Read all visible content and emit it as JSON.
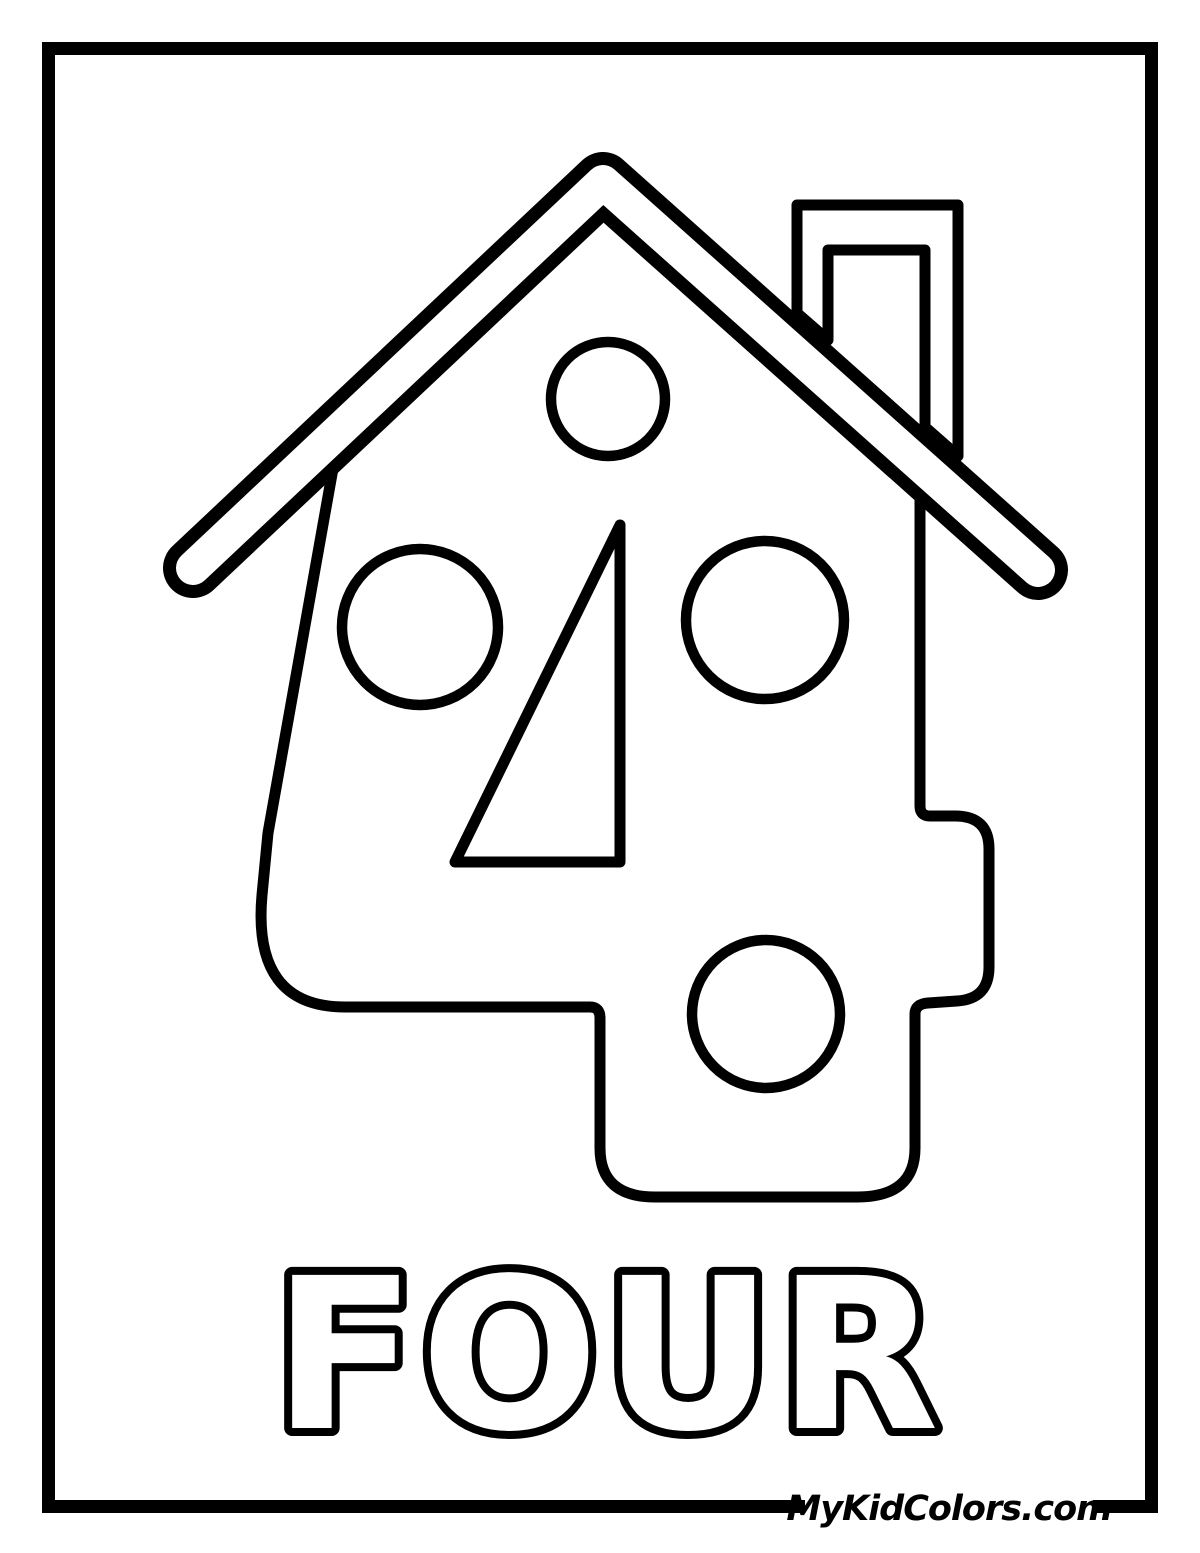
{
  "page": {
    "artwork": "house-shaped-number-four-coloring-outline",
    "background_color": "#ffffff",
    "line_color": "#000000",
    "number_depicted": "4",
    "dot_count": 4,
    "word_label": "FOUR",
    "watermark": "MyKidColors.com"
  }
}
